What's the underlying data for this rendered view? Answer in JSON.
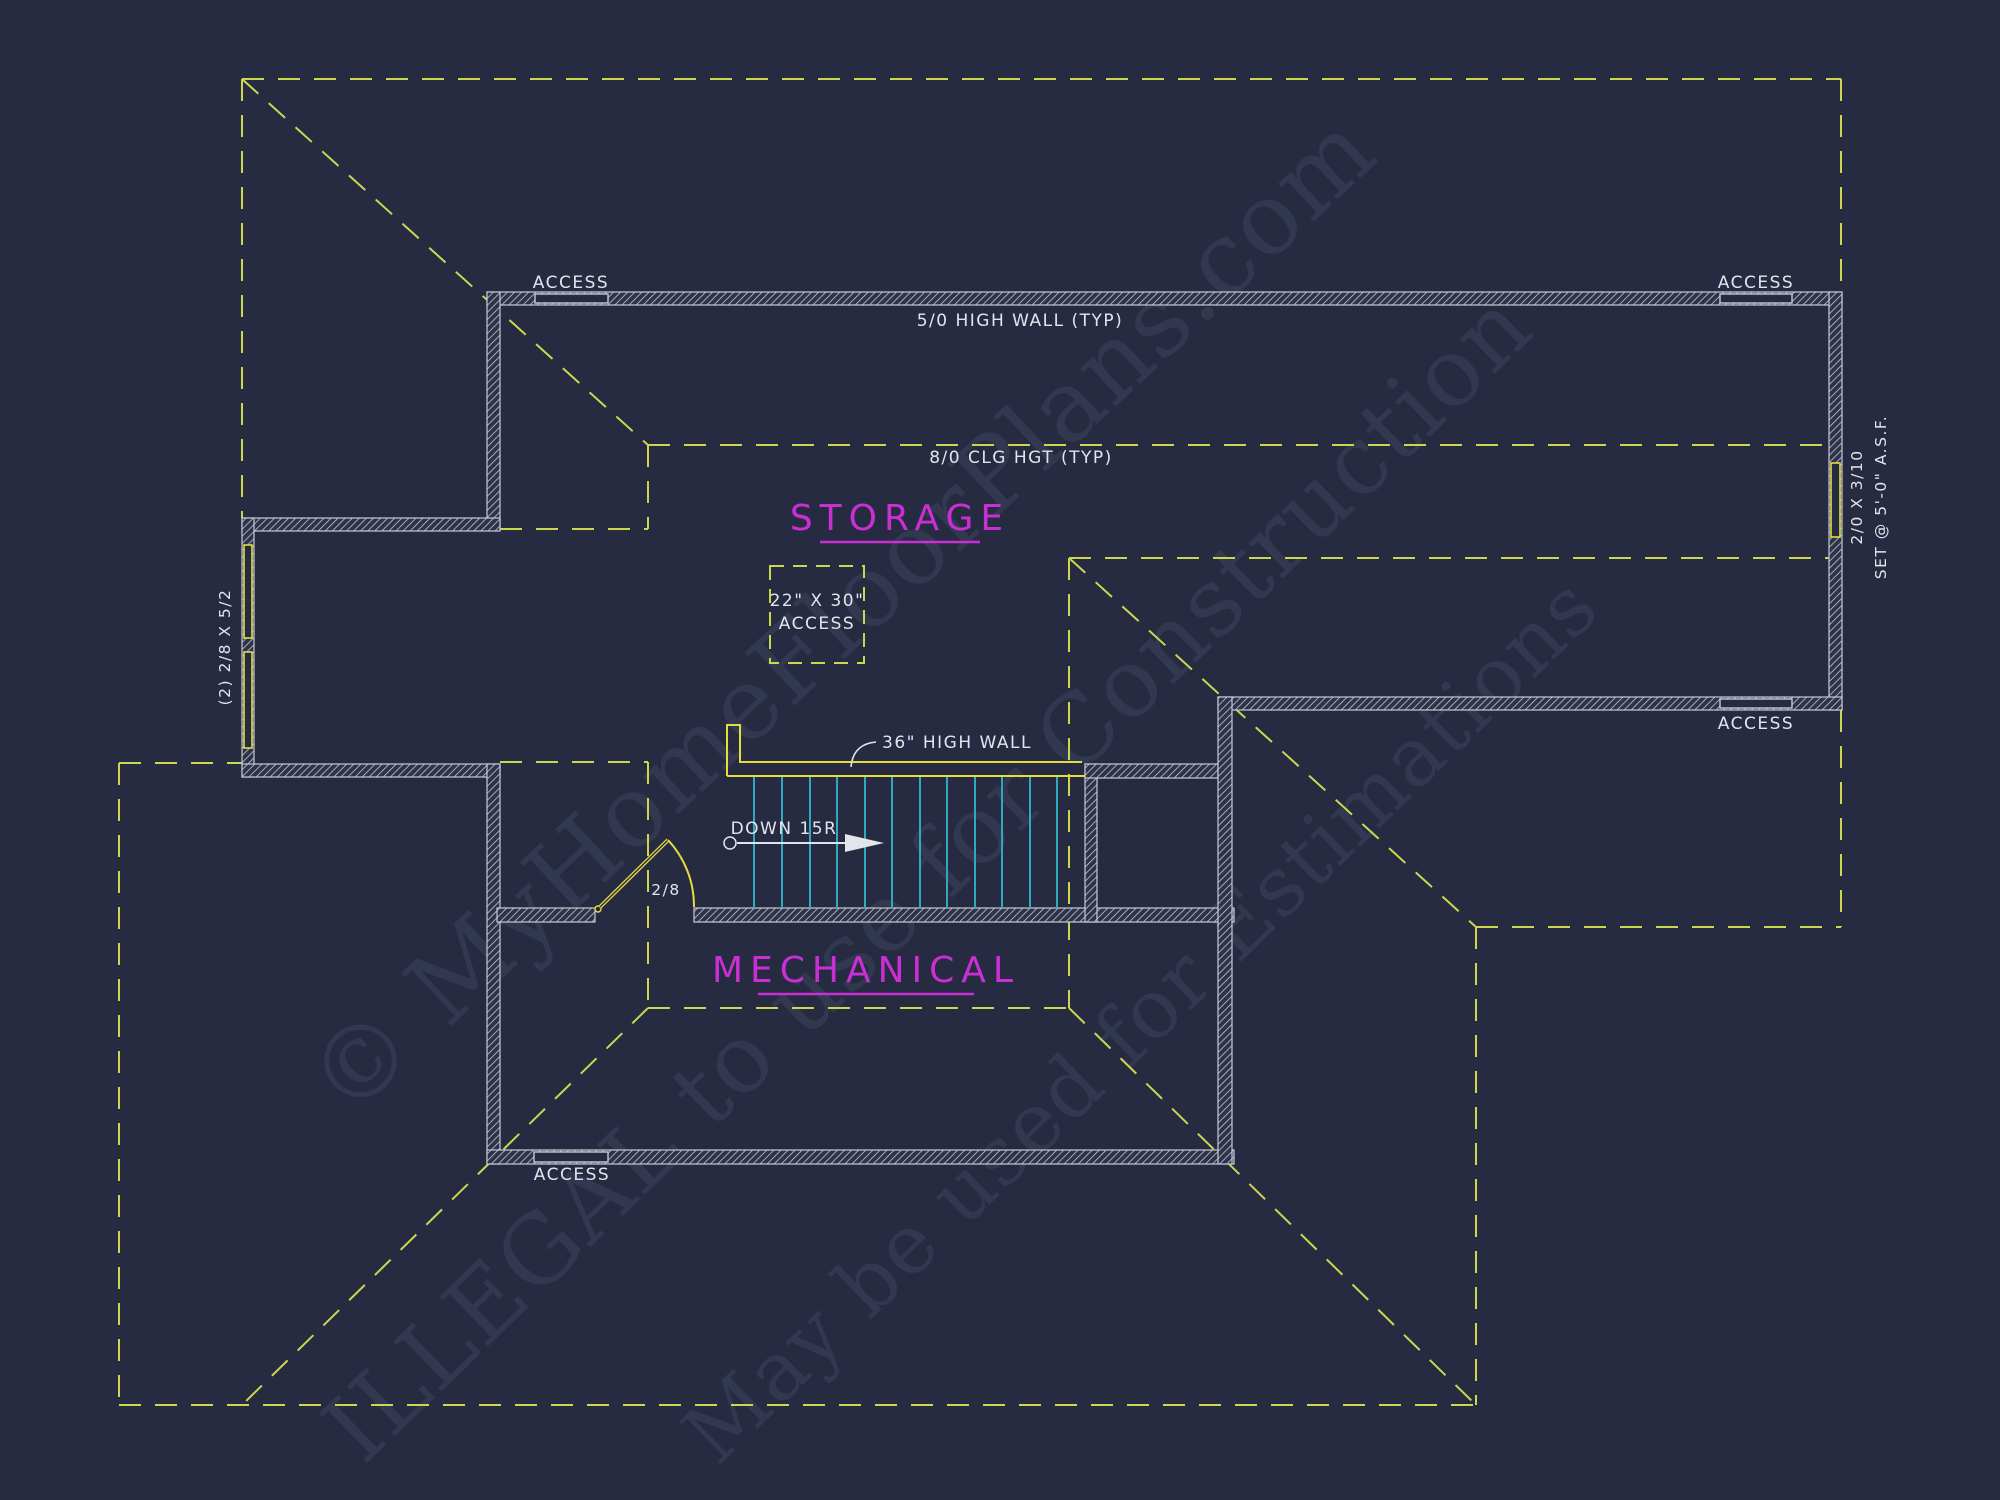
{
  "drawing": {
    "type": "attic / storage floor plan (CAD)",
    "colors": {
      "background": "#262b42",
      "wall_hatch": "#b9bfcc",
      "roofline_dashed": "#ccd64f",
      "fixture_yellow": "#e3dd3d",
      "stair_tread_cyan": "#2fa9bb",
      "room_label_magenta": "#c92fd2",
      "annotation_text": "#e2e5ec"
    }
  },
  "rooms": {
    "storage": "STORAGE",
    "mechanical": "MECHANICAL"
  },
  "annotations": {
    "access": "ACCESS",
    "high_wall_typ": "5/0 HIGH WALL (TYP)",
    "ceiling_height_typ": "8/0 CLG HGT (TYP)",
    "attic_access_size": "22\" X 30\"",
    "attic_access_word": "ACCESS",
    "high_wall_36": "36\" HIGH WALL",
    "stairs_down": "DOWN 15R",
    "door_size": "2/8",
    "left_windows": "(2) 2/8 X 5/2",
    "right_window_size": "2/0 X 3/10",
    "right_window_note": "SET @ 5'-0\" A.S.F."
  },
  "watermark": {
    "line1": "© MyHomeFloorPlans.com",
    "line2": "ILLEGAL to use for Construction",
    "line3": "May be used for Estimations"
  }
}
